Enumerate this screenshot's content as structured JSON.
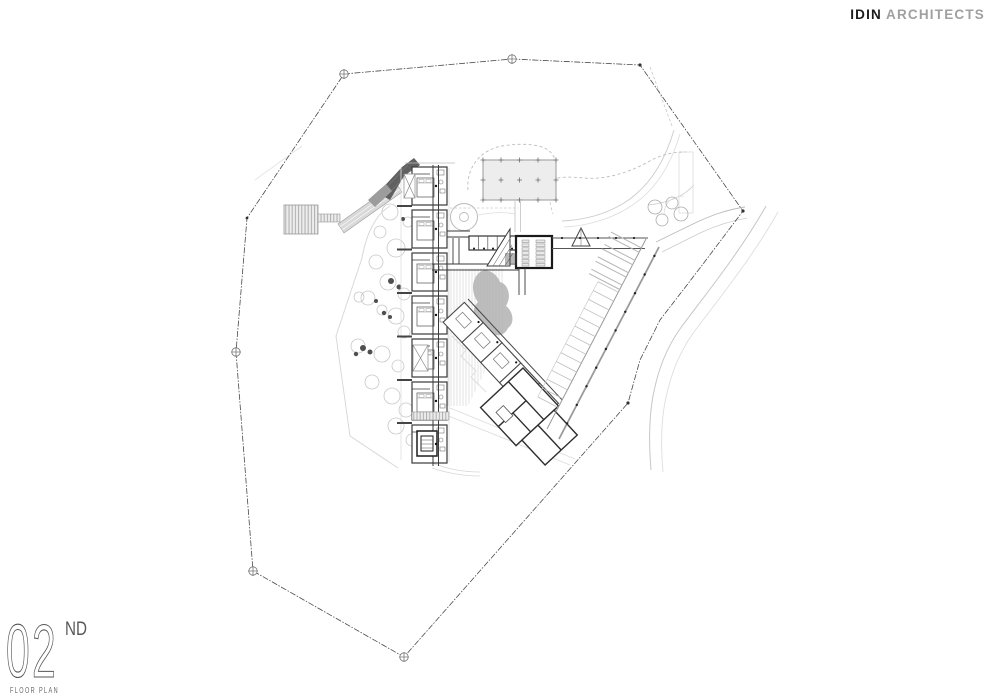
{
  "brand": {
    "name_bold": "IDIN",
    "name_light": "ARCHITECTS"
  },
  "titleblock": {
    "number": "02",
    "ordinal": "ND",
    "label": "FLOOR PLAN"
  },
  "colors": {
    "ink": "#3a3a3a",
    "light_line": "#cdcdcd",
    "logo_gray": "#a0a0a0",
    "title_gray": "#575757",
    "deck_fill": "#ececec",
    "canopy_fill": "#ededed",
    "dark_ramp": "#606060",
    "water_gray": "#b2b2b2"
  }
}
